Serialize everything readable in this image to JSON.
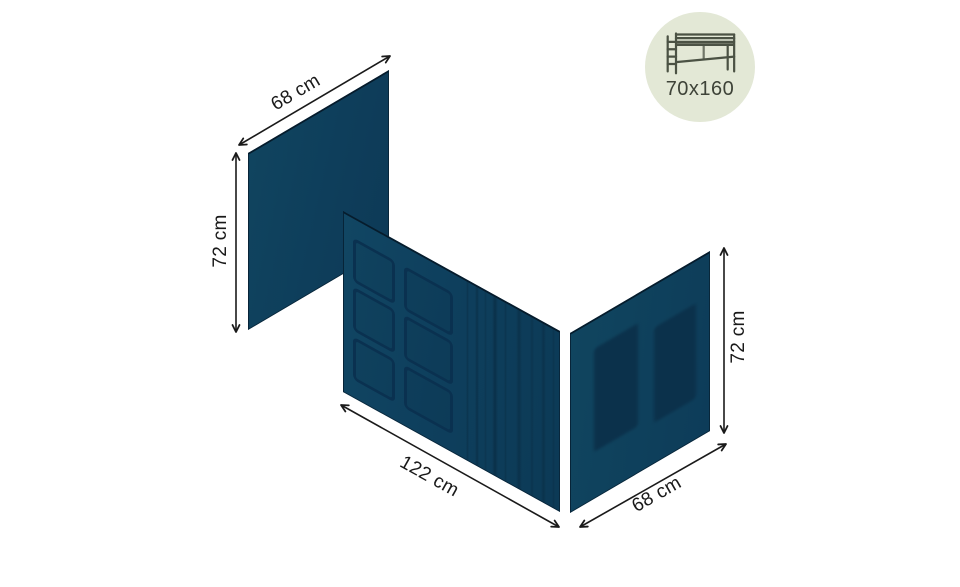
{
  "badge": {
    "label": "70x160"
  },
  "dims": {
    "head_width": "68 cm",
    "head_height": "72 cm",
    "front_width": "122 cm",
    "end_width": "68 cm",
    "end_height": "72 cm"
  },
  "colors": {
    "panel": "#0e3f5d",
    "panel_dark": "#0a3150",
    "window_fill": "#0b314b",
    "badge_bg": "#e3e8d6",
    "badge_icon": "#4b5244",
    "badge_text": "#3e4338",
    "arrow": "#1a1a1a"
  }
}
